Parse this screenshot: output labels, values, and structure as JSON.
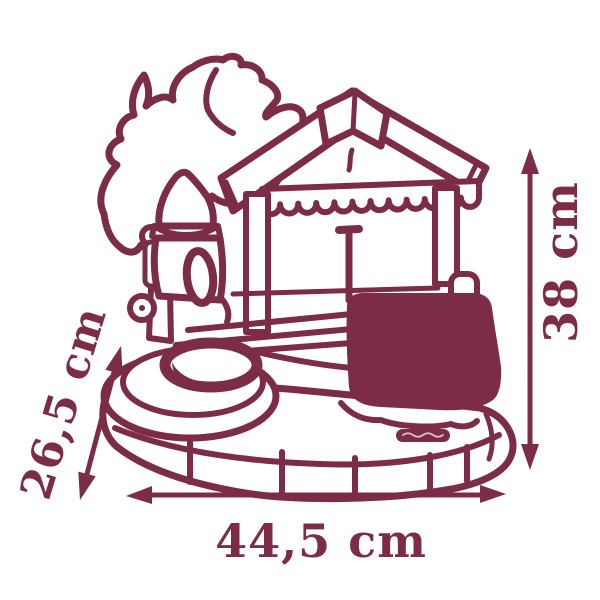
{
  "diagram": {
    "type": "product-dimension-line-drawing",
    "subject": "toy water playset with palm tree, pump tower, canopy roof, basin and base platform",
    "accent_color": "#7d2c48",
    "background_color": "#ffffff",
    "dimensions": {
      "width": "44,5 cm",
      "height": "38 cm",
      "depth": "26,5 cm"
    }
  }
}
